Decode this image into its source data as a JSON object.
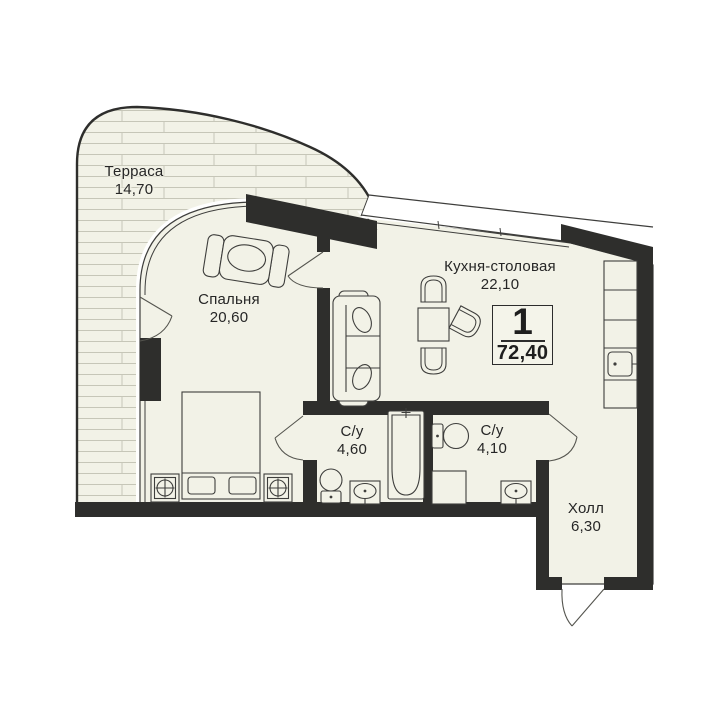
{
  "plan": {
    "title": "Floor plan of 1-room apartment",
    "unit_badge": {
      "rooms": "1",
      "total_area": "72,40"
    },
    "rooms": [
      {
        "id": "terrace",
        "name": "Терраса",
        "area": "14,70"
      },
      {
        "id": "bedroom",
        "name": "Спальня",
        "area": "20,60"
      },
      {
        "id": "kitchen",
        "name": "Кухня-столовая",
        "area": "22,10"
      },
      {
        "id": "bathroom-1",
        "name": "С/у",
        "area": "4,60"
      },
      {
        "id": "bathroom-2",
        "name": "С/у",
        "area": "4,10"
      },
      {
        "id": "hall",
        "name": "Холл",
        "area": "6,30"
      }
    ],
    "colors": {
      "wall": "#2e2e2c",
      "floor": "#f2f2e7",
      "line": "#3e3e3c",
      "hatch": "#c6c6b8"
    }
  }
}
